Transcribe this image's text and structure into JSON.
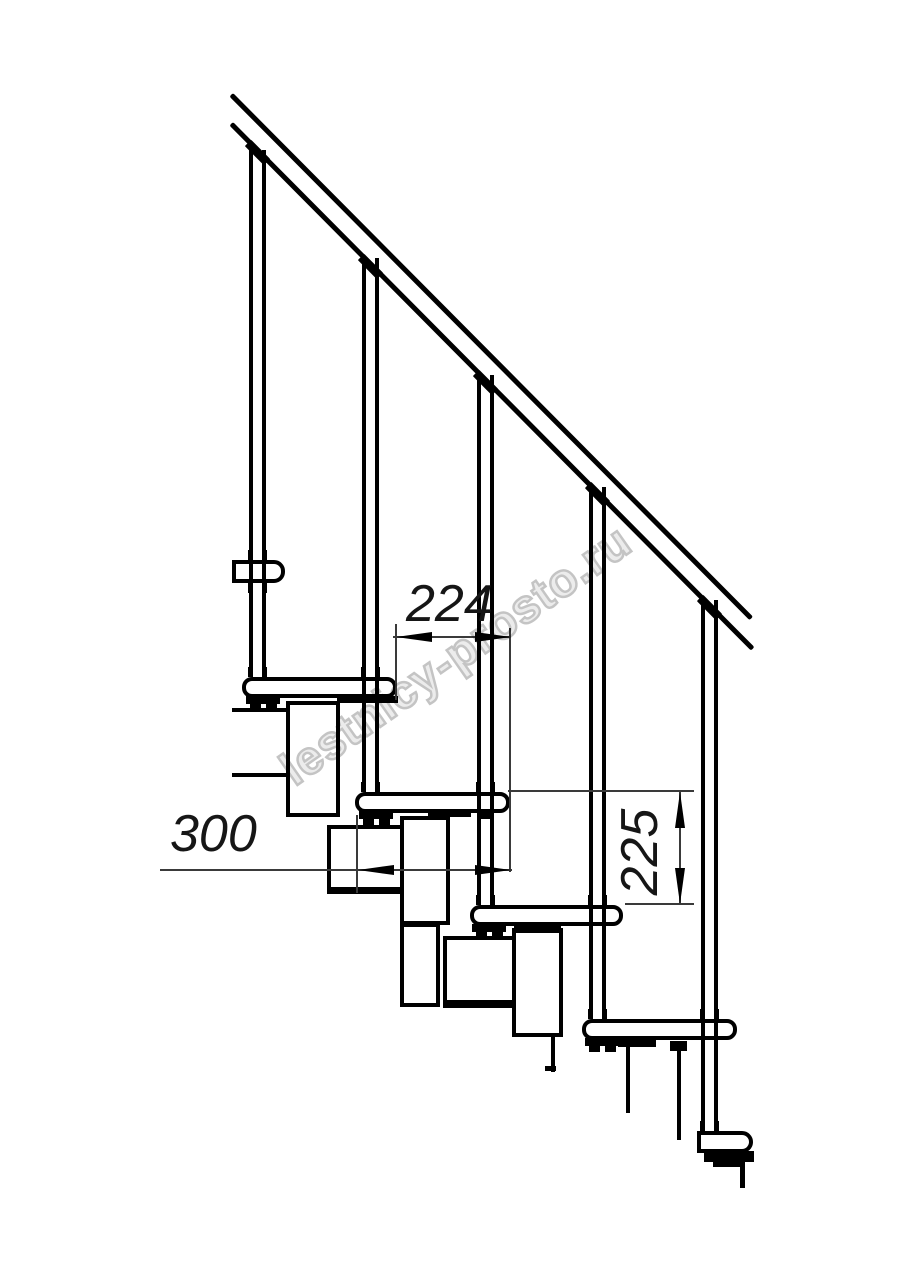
{
  "drawing": {
    "dimensions": {
      "step_overlap_mm": "224",
      "tread_depth_mm": "300",
      "step_height_mm": "225"
    },
    "watermark_text": "lestnicy-prosto.ru",
    "colors": {
      "line": "#000000",
      "dimension_line": "#3a3a3a",
      "watermark": "#c4c4c4",
      "background": "#ffffff"
    }
  }
}
